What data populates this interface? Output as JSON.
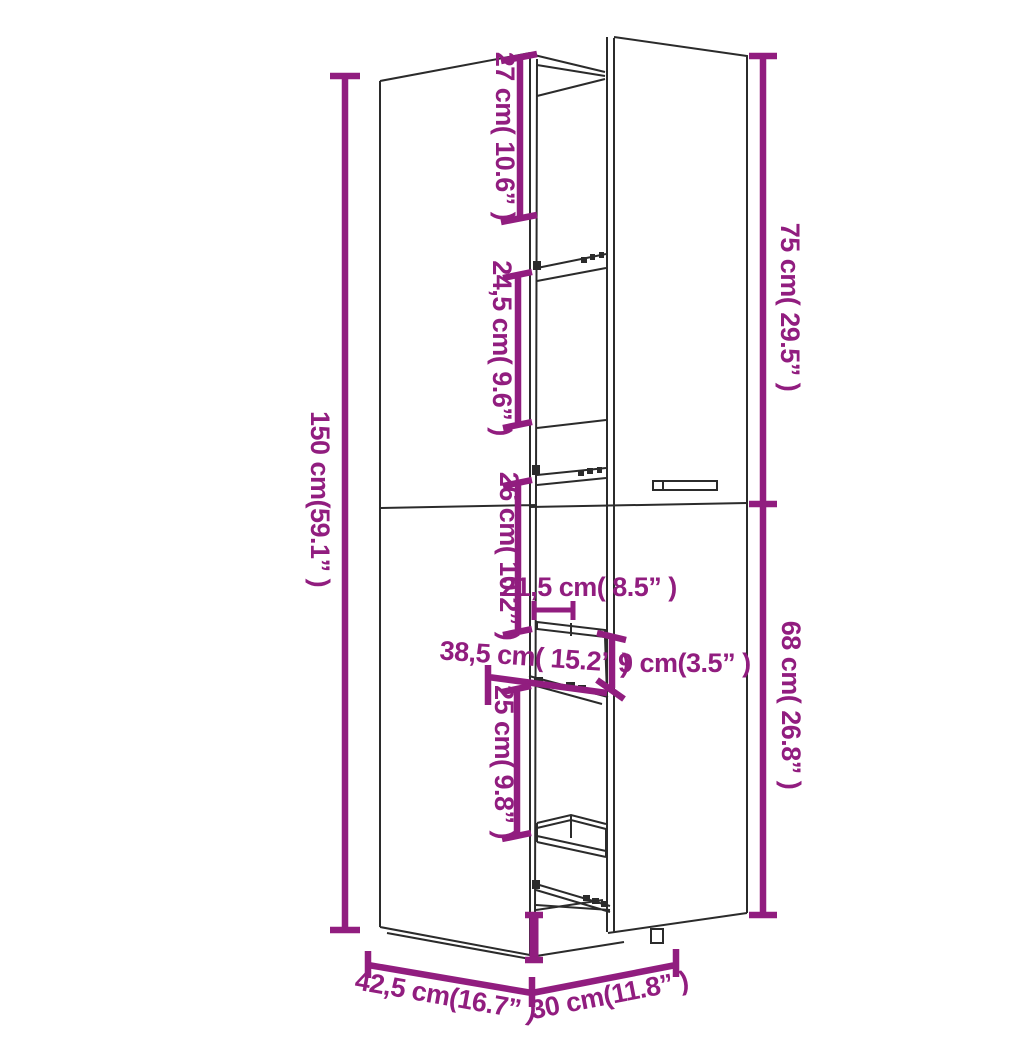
{
  "diagram": {
    "title": "Tall pull-out apothecary cabinet — dimension diagram",
    "accent_color": "#911d7f",
    "line_color": "#2b2b2b",
    "background_color": "#ffffff",
    "units": [
      "cm",
      "inch"
    ],
    "dims": {
      "h150": {
        "label": "150 cm(59.1” )",
        "cm": 150,
        "inch": 59.1
      },
      "v27": {
        "label": "27 cm( 10.6” )",
        "cm": 27,
        "inch": 10.6
      },
      "v245": {
        "label": "24,5 cm( 9.6” )",
        "cm": 24.5,
        "inch": 9.6
      },
      "v75": {
        "label": "75 cm( 29.5” )",
        "cm": 75,
        "inch": 29.5
      },
      "v26": {
        "label": "26 cm( 10.2” )",
        "cm": 26,
        "inch": 10.2
      },
      "h215": {
        "label": "21,5 cm( 8.5” )",
        "cm": 21.5,
        "inch": 8.5
      },
      "h385": {
        "label": "38,5 cm( 15.2” )",
        "cm": 38.5,
        "inch": 15.2
      },
      "h9": {
        "label": "9 cm(3.5” )",
        "cm": 9,
        "inch": 3.5
      },
      "v25": {
        "label": "25 cm( 9.8” )",
        "cm": 25,
        "inch": 9.8
      },
      "v68": {
        "label": "68 cm( 26.8” )",
        "cm": 68,
        "inch": 26.8
      },
      "w425": {
        "label": "42,5 cm(16.7” )",
        "cm": 42.5,
        "inch": 16.7
      },
      "w30": {
        "label": "30 cm(11.8” )",
        "cm": 30,
        "inch": 11.8
      }
    }
  }
}
